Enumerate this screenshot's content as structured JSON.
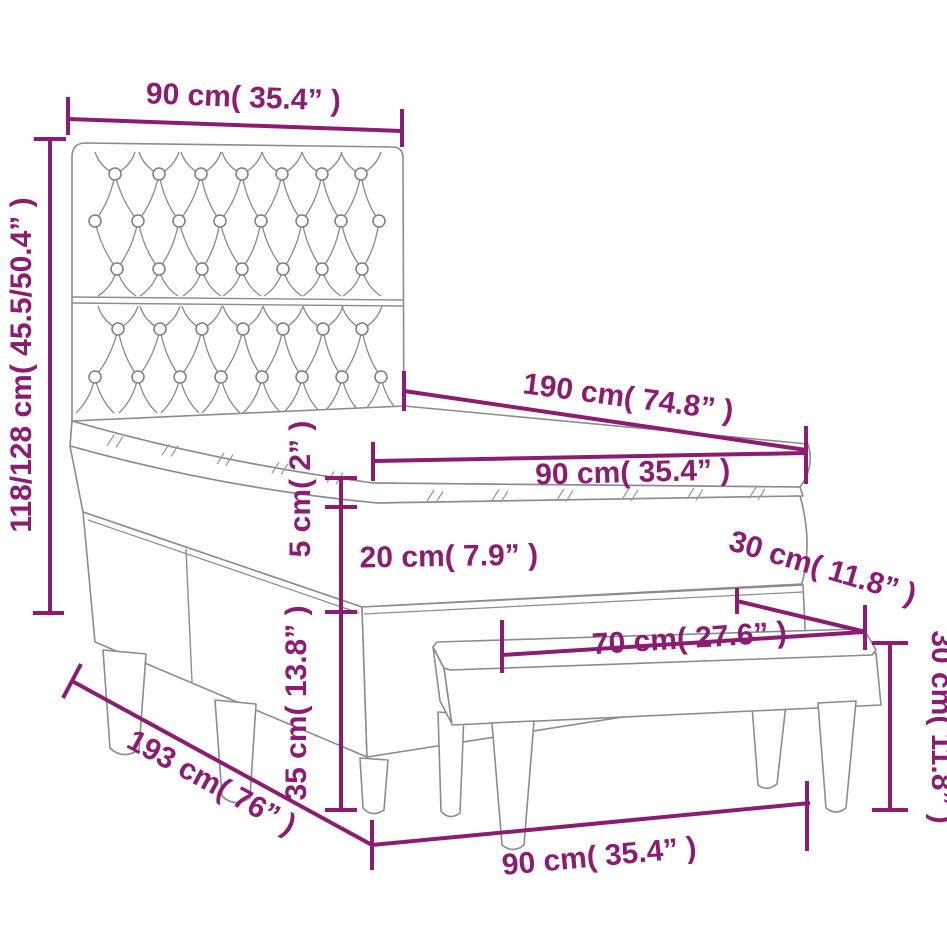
{
  "diagram": {
    "type": "product-dimension-drawing",
    "subject": "box spring bed with tufted headboard and bench",
    "accent_color": "#8B1C72",
    "line_color": "#8C8C8C",
    "background_color": "#FFFFFF",
    "dimensions": {
      "headboard_width": {
        "label": "90 cm( 35.4” )"
      },
      "headboard_height": {
        "label": "118/128 cm( 45.5/50.4” )"
      },
      "bed_length": {
        "label": "190 cm( 74.8” )"
      },
      "mattress_width": {
        "label": "90 cm( 35.4” )"
      },
      "topper_thickness": {
        "label": "5 cm( 2” )"
      },
      "mattress_thickness": {
        "label": "20 cm( 7.9” )"
      },
      "base_height": {
        "label": "35 cm( 13.8” )"
      },
      "total_length": {
        "label": "193 cm( 76” )"
      },
      "bed_width_bottom": {
        "label": "90 cm( 35.4” )"
      },
      "bench_depth": {
        "label": "30 cm( 11.8” )"
      },
      "bench_length": {
        "label": "70 cm( 27.6” )"
      },
      "bench_height": {
        "label": "30 cm( 11.8” )"
      }
    }
  }
}
